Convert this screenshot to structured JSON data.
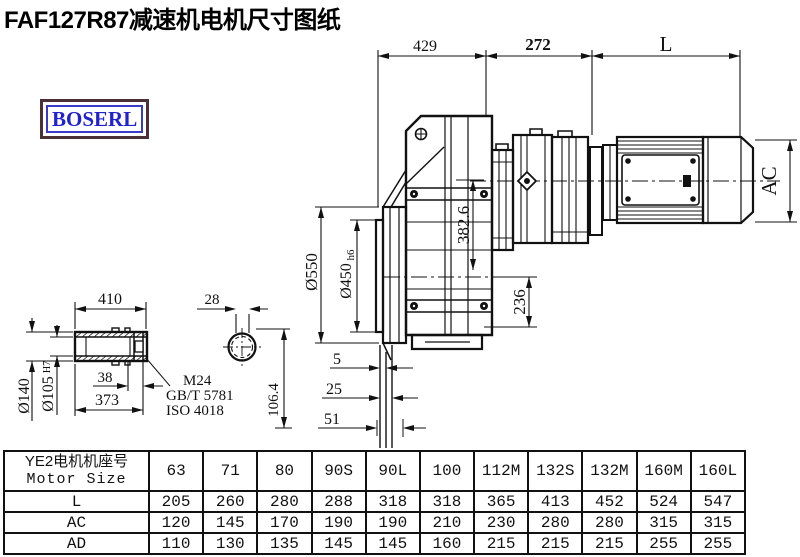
{
  "title": "FAF127R87减速机电机尺寸图纸",
  "logo": {
    "text": "BOSERL"
  },
  "drawing": {
    "dim_429": "429",
    "dim_272": "272",
    "dim_L": "L",
    "dim_AC": "AC",
    "dim_dia550": "Ø550",
    "dim_dia450": "Ø450",
    "dim_dia450_tol": "h6",
    "dim_382_6": "382.6",
    "dim_236": "236",
    "dim_410": "410",
    "dim_28": "28",
    "dim_dia140": "Ø140",
    "dim_dia105": "Ø105",
    "dim_dia105_tol": "H7",
    "dim_38": "38",
    "dim_373": "373",
    "note_thread": "M24",
    "note_standard_gb": "GB/T 5781",
    "note_standard_iso": "ISO 4018",
    "dim_106_4": "106.4",
    "dim_5": "5",
    "dim_25": "25",
    "dim_51": "51"
  },
  "table": {
    "header": {
      "line1": "YE2电机机座号",
      "line2": "Motor Size"
    },
    "columns": [
      "63",
      "71",
      "80",
      "90S",
      "90L",
      "100",
      "112M",
      "132S",
      "132M",
      "160M",
      "160L"
    ],
    "rows": [
      {
        "label": "L",
        "values": [
          "205",
          "260",
          "280",
          "288",
          "318",
          "318",
          "365",
          "413",
          "452",
          "524",
          "547"
        ]
      },
      {
        "label": "AC",
        "values": [
          "120",
          "145",
          "170",
          "190",
          "190",
          "210",
          "230",
          "280",
          "280",
          "315",
          "315"
        ]
      },
      {
        "label": "AD",
        "values": [
          "110",
          "130",
          "135",
          "145",
          "145",
          "160",
          "215",
          "215",
          "215",
          "255",
          "255"
        ]
      }
    ]
  },
  "colors": {
    "ink": "#111111",
    "logo_text": "#2222cc",
    "logo_border": "#4b3136",
    "background": "#ffffff"
  }
}
